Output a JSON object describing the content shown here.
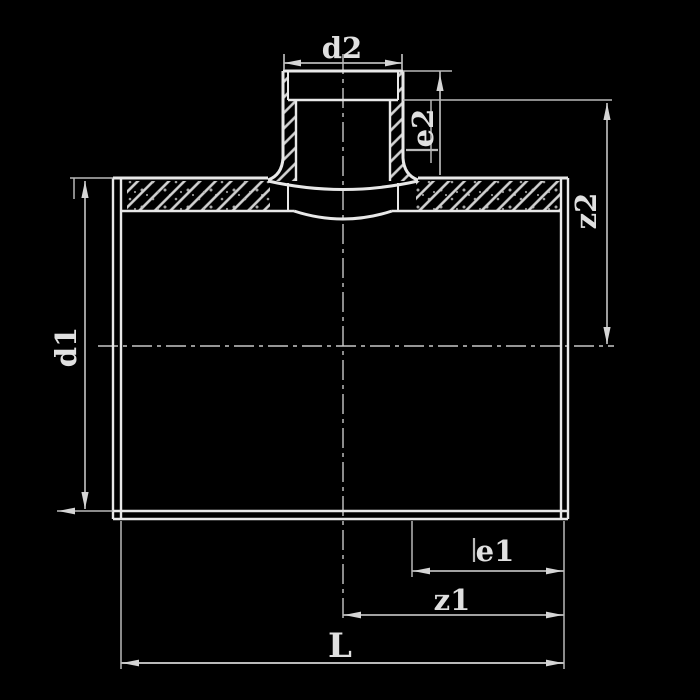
{
  "drawing": {
    "kind": "technical-section-drawing",
    "background_color": "#000000",
    "outline_color": "#e8e8e8",
    "dimension_color": "#b9b9b9",
    "hatch_color": "#d2d2d2",
    "text_color": "#e0e0e0",
    "labels": {
      "d1": "d1",
      "d2": "d2",
      "e1": "e1",
      "e2": "e2",
      "z1": "z1",
      "z2": "z2",
      "L": "L"
    },
    "dimensions": [
      {
        "label": "d2",
        "orientation": "horizontal",
        "location": "top, across branch socket"
      },
      {
        "label": "e2",
        "orientation": "vertical-rotated",
        "location": "right of branch socket"
      },
      {
        "label": "z2",
        "orientation": "vertical-rotated",
        "location": "right side, socket shoulder to main axis"
      },
      {
        "label": "d1",
        "orientation": "vertical-rotated",
        "location": "left side, across main body"
      },
      {
        "label": "e1",
        "orientation": "horizontal",
        "location": "bottom right, socket depth of run"
      },
      {
        "label": "z1",
        "orientation": "horizontal",
        "location": "bottom, branch axis to right face"
      },
      {
        "label": "L",
        "orientation": "horizontal",
        "location": "bottom, overall length"
      }
    ]
  }
}
